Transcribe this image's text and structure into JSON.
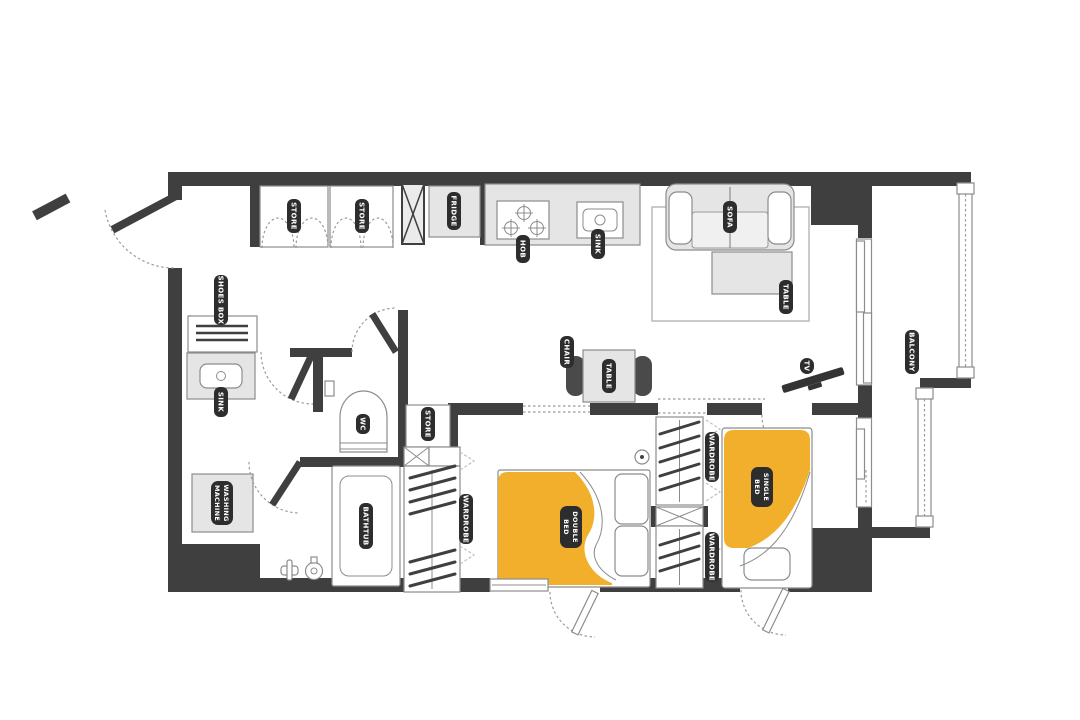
{
  "labels": {
    "store_1": "STORE",
    "store_2": "STORE",
    "store_3": "STORE",
    "fridge": "FRIDGE",
    "hob": "HOB",
    "kitchen_sink": "SINK",
    "sofa": "SOFA",
    "coffee_table": "TABLE",
    "tv": "TV",
    "balcony": "BALCONY",
    "chair": "CHAIR",
    "dining_table": "TABLE",
    "shoes_box": "SHOES BOX",
    "bathroom_sink": "SINK",
    "washing_machine_l1": "WASHING",
    "washing_machine_l2": "MACHINE",
    "wc": "WC",
    "bathtub": "BATHTUB",
    "wardrobe_1": "WARDROBE",
    "wardrobe_2": "WARDROBE",
    "wardrobe_3": "WARDROBE",
    "double_bed_l1": "DOUBLE",
    "double_bed_l2": "BED",
    "single_bed_l1": "SINGLE",
    "single_bed_l2": "BED"
  },
  "colors": {
    "wall": "#3F3F3F",
    "furniture": "#E5E5E5",
    "outline": "#8C8C8C",
    "bed_accent": "#F2AF2B",
    "label_bg": "#2D2D2D",
    "label_text": "#FFFFFF",
    "floor": "#FFFFFF"
  }
}
